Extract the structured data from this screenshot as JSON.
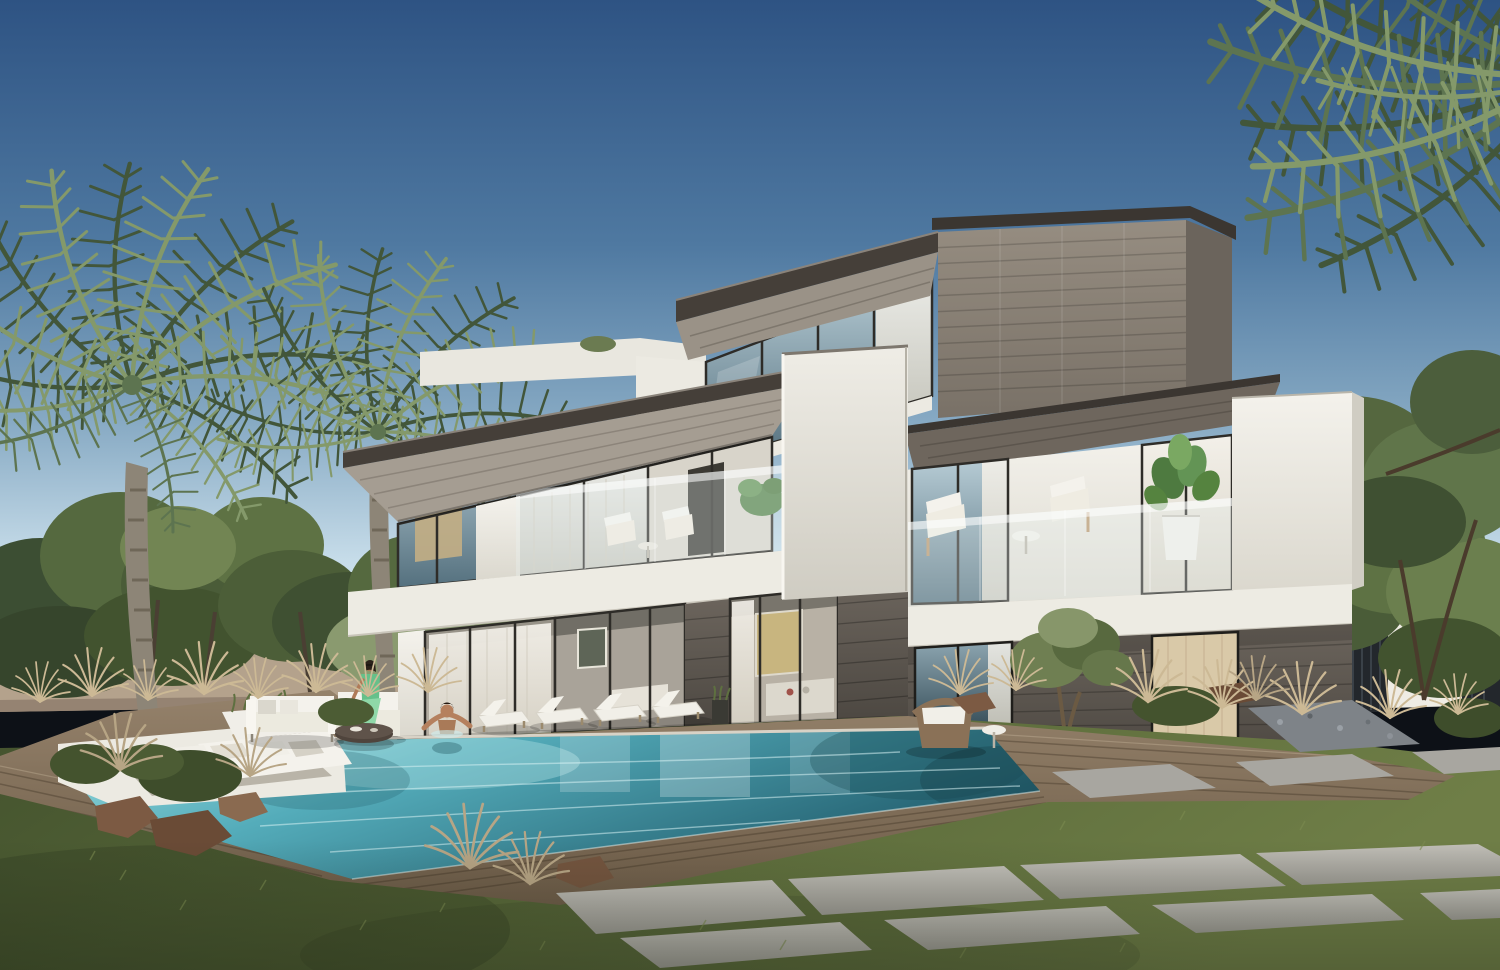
{
  "scene": {
    "title": "Modern three-storey villa with infinity pool — architectural rendering",
    "time_of_day": "clear afternoon",
    "setting": "landscaped garden with lawn, timber pool deck, stone pavers, boundary wall, palms and olive trees",
    "villa": {
      "storeys": 3,
      "features": [
        "cantilevered dark roof slabs",
        "white stucco volumes",
        "grey stone-clad top box",
        "stone ground floor",
        "floor-to-ceiling glazing with white curtains",
        "glass balustrade balconies"
      ]
    },
    "pool": {
      "style": "infinity edge with sunken lounge and timber surround"
    },
    "people": [
      {
        "label": "woman in green dress seated on outdoor armchair"
      },
      {
        "label": "man relaxing in pool with arms on the edge"
      }
    ],
    "furniture": [
      "white outdoor sofa",
      "outdoor armchair",
      "round dark coffee table",
      "four white sun loungers",
      "balcony armchairs with side tables",
      "potted fiddle-leaf plant",
      "wicker lounge chair with side table"
    ],
    "vegetation": [
      "two date palms left",
      "palm fronds overhanging top right",
      "olive and broadleaf trees",
      "ornamental dry grasses",
      "shrubs",
      "rocks"
    ]
  },
  "palette": {
    "sky_top": "#2e5383",
    "sky_mid": "#86a9c3",
    "sky_horizon": "#dce9f1",
    "palm_dark": "#42563a",
    "palm_mid": "#5d7450",
    "palm_light": "#84996a",
    "trunk": "#8d8577",
    "tree_dark": "#3c4e33",
    "tree_mid": "#55693f",
    "tree_light": "#728553",
    "olive": "#8a9a6f",
    "wall_beige": "#b4a28c",
    "fence_dark": "#23272c",
    "white_top": "#f4f2ec",
    "white_bottom": "#dbd8ce",
    "stone_top": "#968d81",
    "stone_bottom": "#797167",
    "stone_dark_top": "#6b645c",
    "stone_dark_bottom": "#4d4842",
    "roof_dark": "#453f39",
    "soffit": "#a59d92",
    "glass_top": "#b7ccd5",
    "glass_bottom": "#54707e",
    "glass_dark_top": "#8ca5b0",
    "glass_dark_bottom": "#39505b",
    "curtain_light": "#f3f0e9",
    "curtain_dark": "#d7d2c5",
    "water_light": "#9cdfe2",
    "water_mid": "#54acba",
    "water_dark": "#235f6f",
    "deck_light": "#95826b",
    "deck_dark": "#6d5c48",
    "paver_light": "#c1bfb8",
    "paver_dark": "#9c9a93",
    "grass_light": "#6f7e47",
    "grass_dark": "#44532e",
    "dry_grass": "#ccb995",
    "rock": "#7c5a43",
    "skin": "#b5805e",
    "dress_green": "#8fd8a8",
    "cushion_white": "#f1efe8",
    "wicker": "#8a7157"
  }
}
